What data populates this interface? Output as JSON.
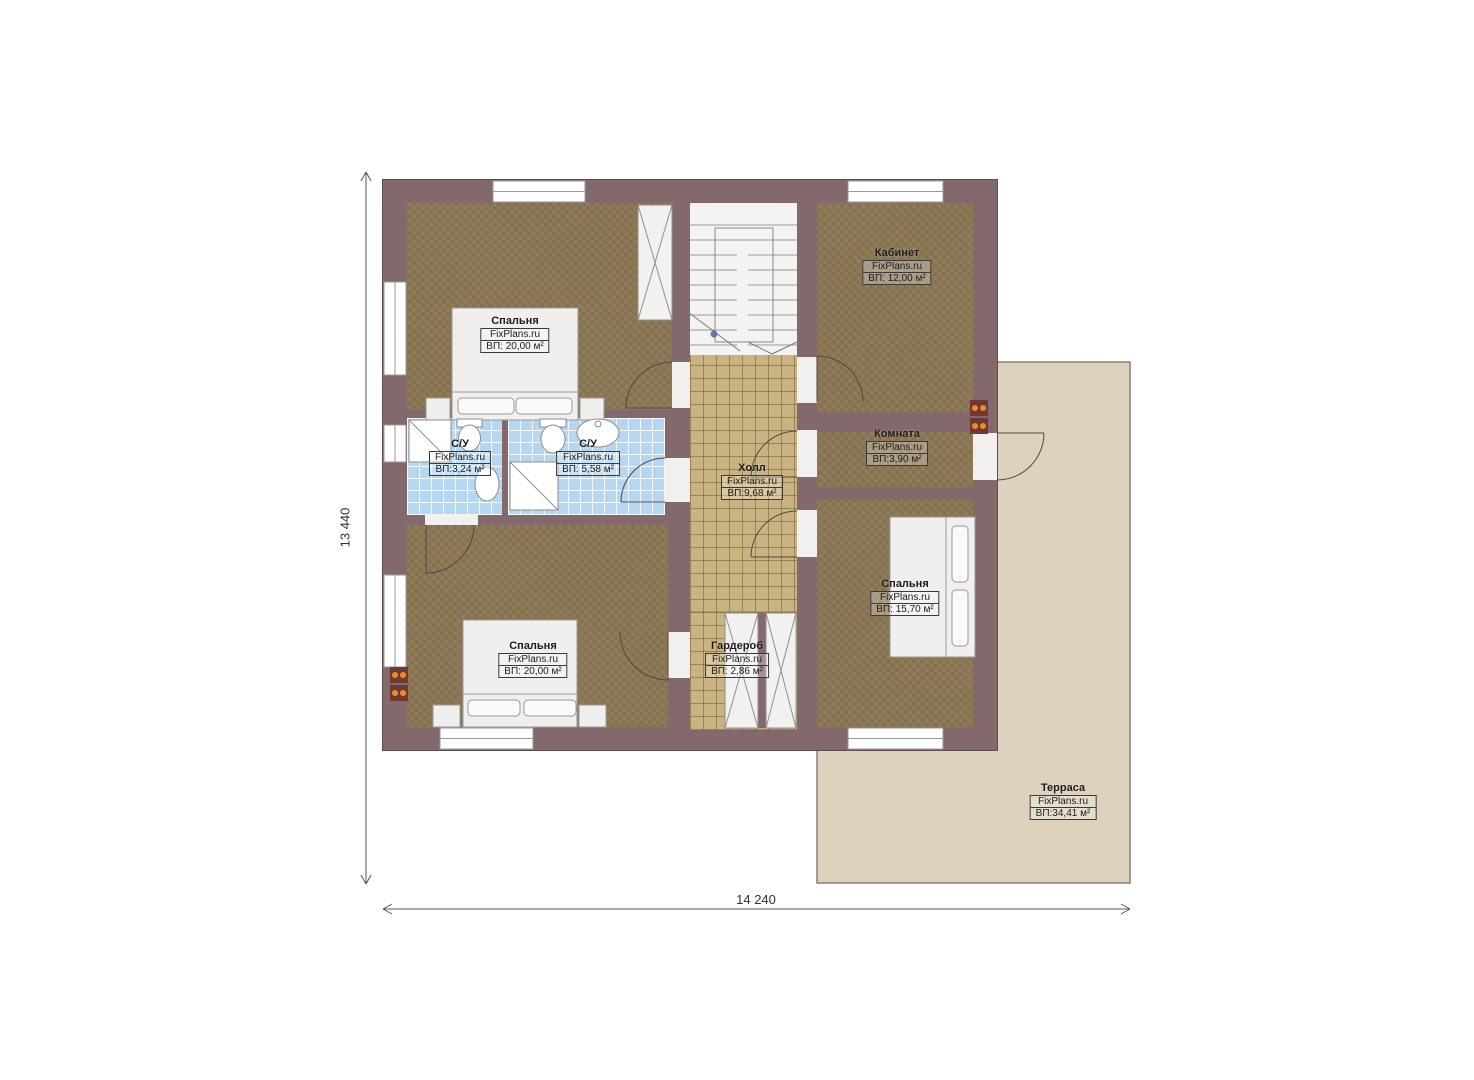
{
  "page": {
    "title": "Floor plan — second floor",
    "width": 1474,
    "height": 1080
  },
  "brand": "FixPlans.ru",
  "dimensions": {
    "left": "13 440",
    "bottom": "14 240"
  },
  "colors": {
    "wall": "#84696c",
    "wood_floor": "#8c7754",
    "tile_floor": "#c9b382",
    "bath_tile": "#b5d7f2",
    "terrace": "#dcd2bd",
    "stairwell": "#f4f3f1",
    "radiator_dot": "#f08a2e",
    "label_border": "#3a3a3a",
    "dimension_line": "#555555"
  },
  "rooms": [
    {
      "name": "Спальня",
      "area": "ВП: 20,00 м²"
    },
    {
      "name": "Кабинет",
      "area": "ВП: 12,00 м²"
    },
    {
      "name": "С/У",
      "area": "ВП:3,24 м²"
    },
    {
      "name": "С/У",
      "area": "ВП: 5,58 м²"
    },
    {
      "name": "Холл",
      "area": "ВП:9,68 м²"
    },
    {
      "name": "Комната",
      "area": "ВП:3,90 м²"
    },
    {
      "name": "Спальня",
      "area": "ВП: 15,70 м²"
    },
    {
      "name": "Гардероб",
      "area": "ВП: 2,86 м²"
    },
    {
      "name": "Спальня",
      "area": "ВП: 20,00 м²"
    },
    {
      "name": "Терраса",
      "area": "ВП:34,41 м²"
    }
  ]
}
